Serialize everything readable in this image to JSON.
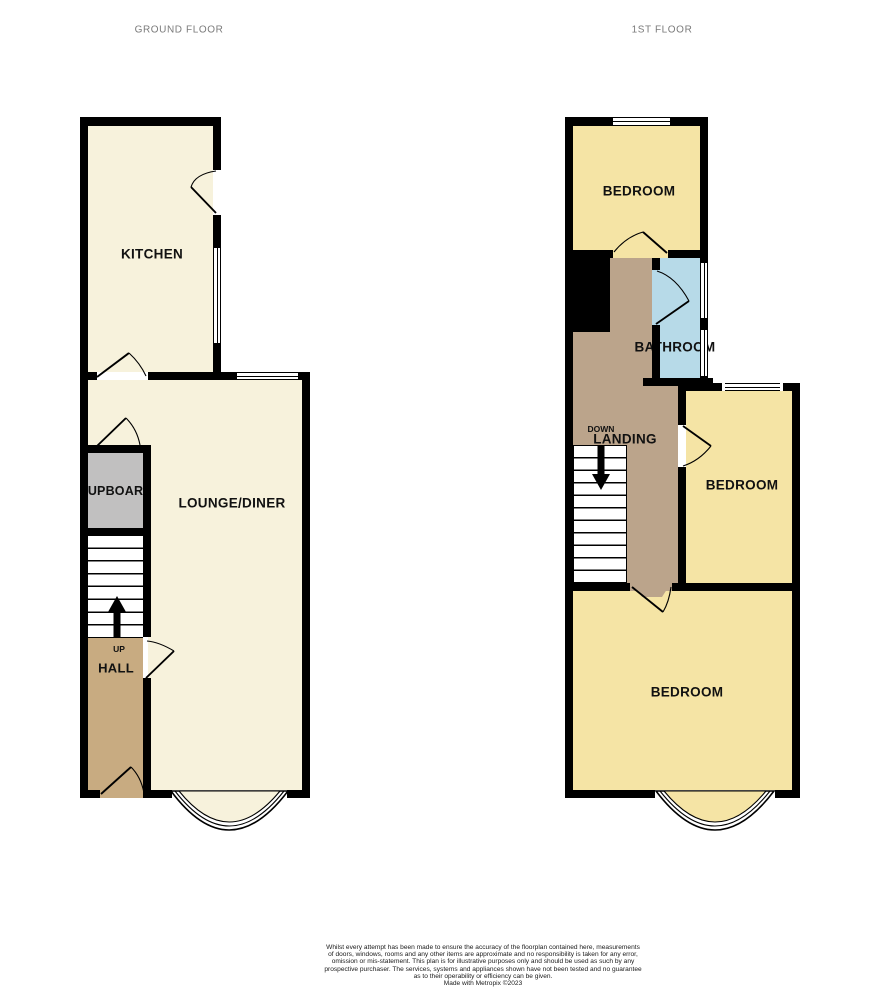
{
  "titles": {
    "ground": "GROUND FLOOR",
    "first": "1ST FLOOR"
  },
  "ground_floor": {
    "kitchen": "KITCHEN",
    "lounge": "LOUNGE/DINER",
    "cupboard": "CUPBOARD",
    "hall": "HALL",
    "stairs_direction": "UP"
  },
  "first_floor": {
    "bedroom_front": "BEDROOM",
    "bedroom_middle": "BEDROOM",
    "bedroom_back": "BEDROOM",
    "bathroom": "BATHROOM",
    "landing": "LANDING",
    "stairs_direction": "DOWN"
  },
  "footer": {
    "disclaimer_lines": [
      "Whilst every attempt has been made to ensure the accuracy of the floorplan contained here, measurements",
      "of doors, windows, rooms and any other items are approximate and no responsibility is taken for any error,",
      "omission or mis-statement. This plan is for illustrative purposes only and should be used as such by any",
      "prospective purchaser. The services, systems and appliances shown have not been tested and no guarantee",
      "as to their operability or efficiency can be given."
    ],
    "credit": "Made with Metropix ©2023"
  },
  "colors": {
    "room_cream": "#F7F2DC",
    "room_yellow": "#F5E4A5",
    "hall_tan": "#C8AB81",
    "landing_tan": "#BBA48B",
    "bathroom_blue": "#B7DAE8",
    "cupboard_grey": "#C1C0C0",
    "wall_black": "#000000",
    "title_grey": "#7A7A7A"
  }
}
